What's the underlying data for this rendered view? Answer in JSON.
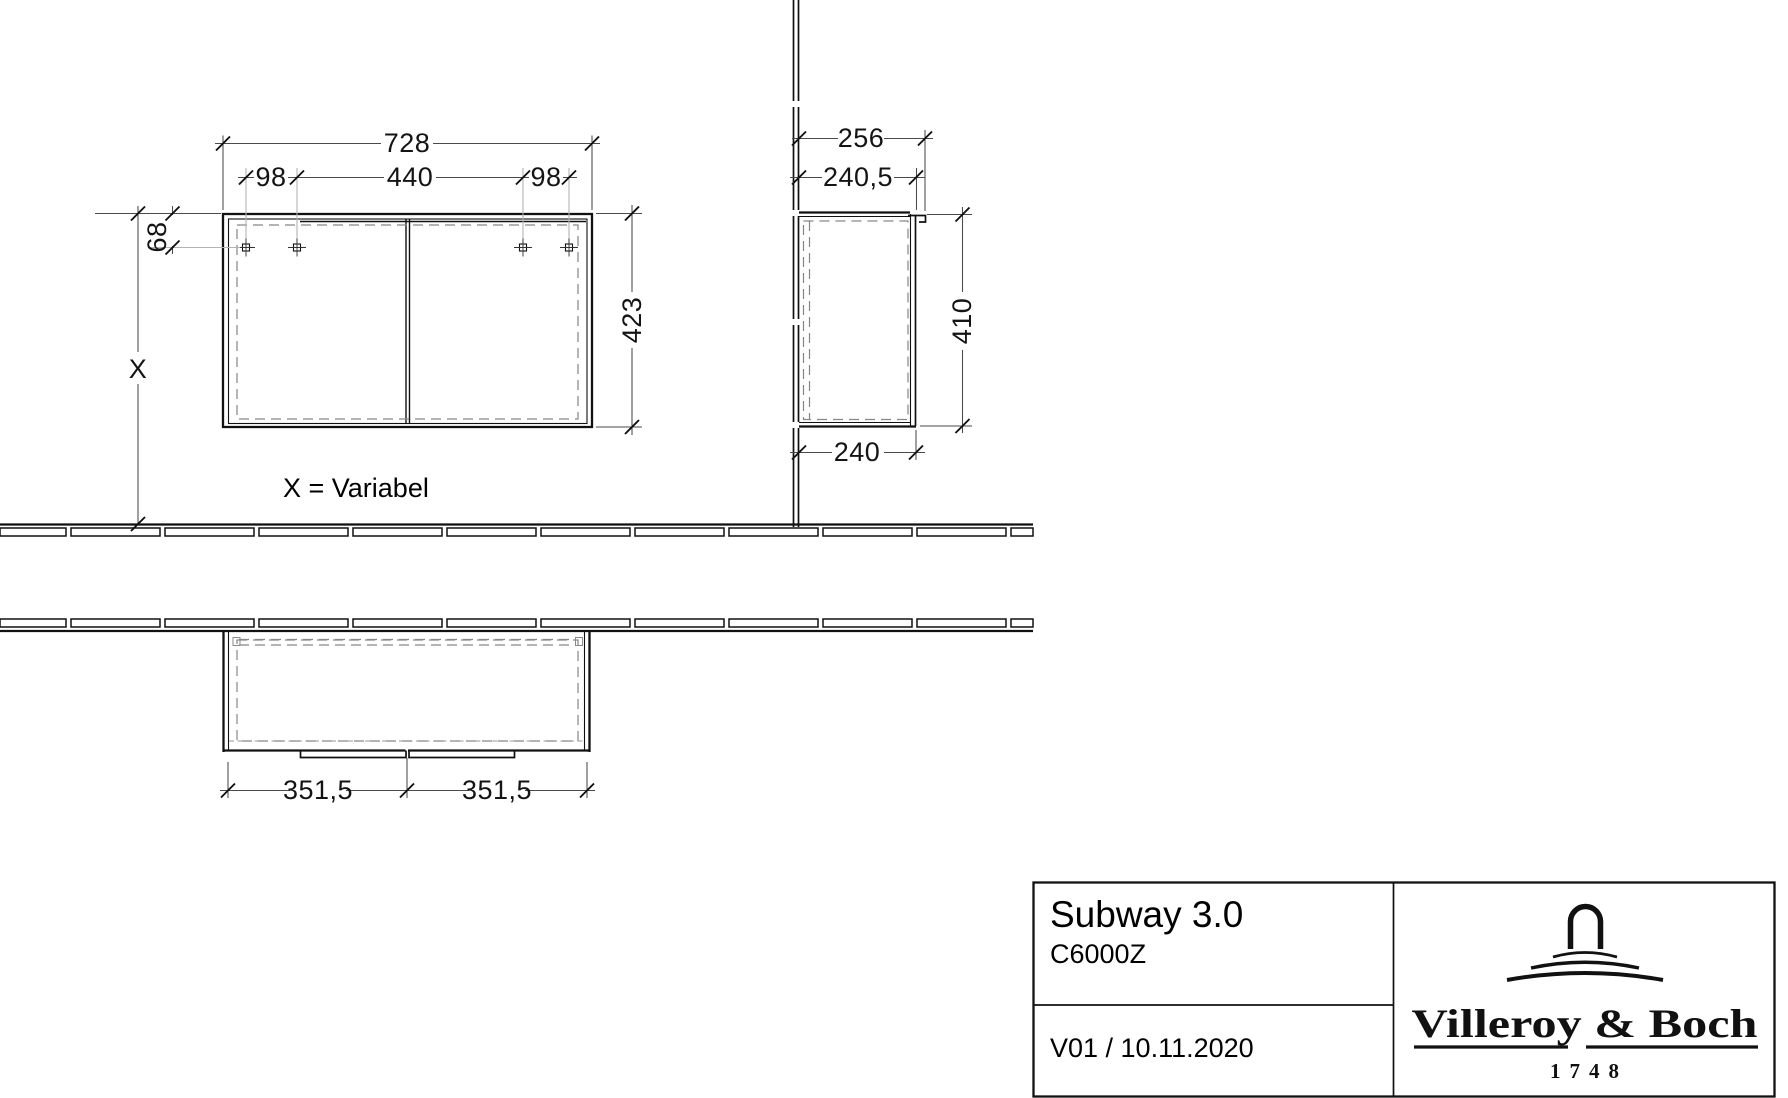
{
  "drawing": {
    "front_view": {
      "dim_width_total": "728",
      "dim_hole_left": "98",
      "dim_hole_center": "440",
      "dim_hole_right": "98",
      "dim_hole_top": "68",
      "dim_height": "423",
      "dim_floor_distance": "X",
      "note": "X = Variabel"
    },
    "side_view": {
      "dim_depth_total": "256",
      "dim_depth_front": "240,5",
      "dim_height": "410",
      "dim_depth_carcass": "240"
    },
    "plan_view": {
      "dim_door_left": "351,5",
      "dim_door_right": "351,5"
    }
  },
  "title_block": {
    "product": "Subway 3.0",
    "model": "C6000Z",
    "version": "V01 / 10.11.2020",
    "brand": "Villeroy & Boch",
    "since": "1748"
  },
  "colors": {
    "line": "#111111",
    "hidden_line": "#868686",
    "background": "#ffffff"
  }
}
